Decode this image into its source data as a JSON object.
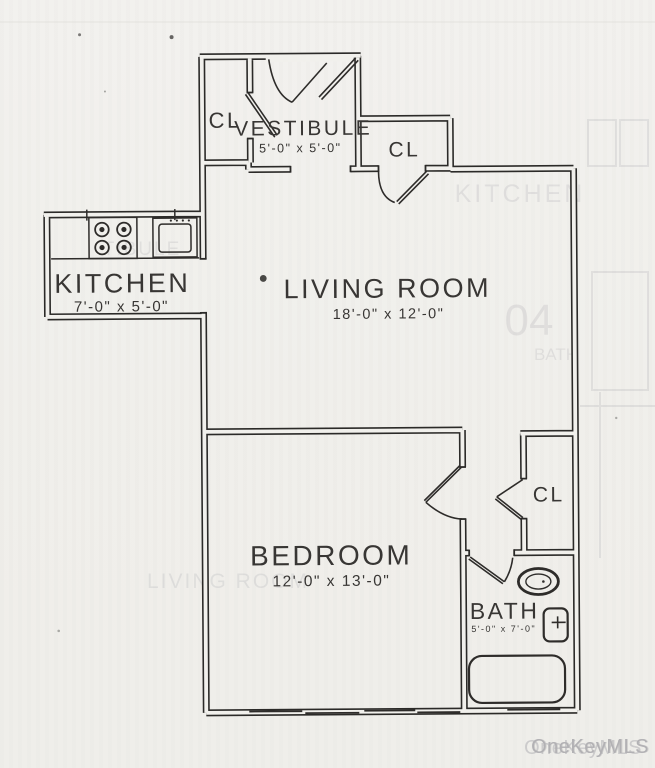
{
  "rooms": {
    "vestibule": {
      "label": "VESTIBULE",
      "dims": "5'-0\" x 5'-0\""
    },
    "vestibule_closet": {
      "label": "CL"
    },
    "entry_closet": {
      "label": "CL"
    },
    "kitchen": {
      "label": "KITCHEN",
      "dims": "7'-0\" x 5'-0\""
    },
    "living_room": {
      "label": "LIVING ROOM",
      "dims": "18'-0\" x 12'-0\""
    },
    "bedroom": {
      "label": "BEDROOM",
      "dims": "12'-0\" x 13'-0\""
    },
    "hall_closet": {
      "label": "CL"
    },
    "bath": {
      "label": "BATH",
      "dims": "5'-0\" x 7'-0\""
    }
  },
  "watermark": {
    "text": "OneKeyMLS",
    "color": "#b2b1b4"
  },
  "ghost_bleedthrough": {
    "kitchen": "KITCHEN",
    "unit_number": "04",
    "bath": "BATH",
    "living_room": "LIVING ROOM",
    "vestibule_fragment": "TIBULE"
  },
  "colors": {
    "paper": "#f1f0ec",
    "ink": "#2b2a28",
    "watermark": "#b2b1b4"
  }
}
